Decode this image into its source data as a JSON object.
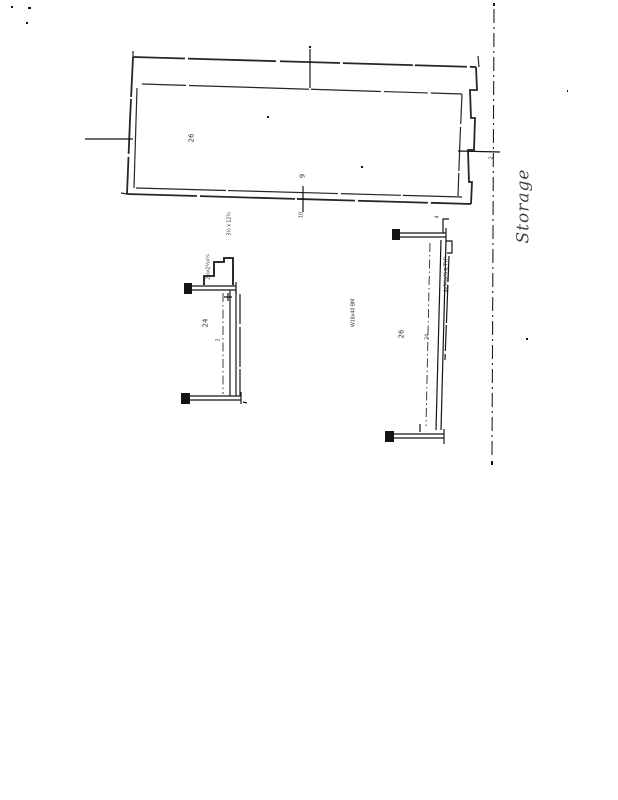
{
  "theme": {
    "paper": "#ffffff",
    "ink": "#141414"
  },
  "plan": {
    "room_label": "26",
    "bottom_dim_label": "9",
    "bottom_tick_note": "10",
    "right_tick_note": "2"
  },
  "notes": {
    "scale_note": "3½ x 12½",
    "clip_note": "2½x2½x¼",
    "mid_note": "W18x40 BM",
    "handwritten_note": "Storage"
  },
  "detail_left": {
    "label": "24",
    "center_mark": "2"
  },
  "detail_right": {
    "top_note": "4",
    "plate_note": "4x5½x¼ ℄ TYP",
    "label": "26",
    "center_mark": "24"
  }
}
